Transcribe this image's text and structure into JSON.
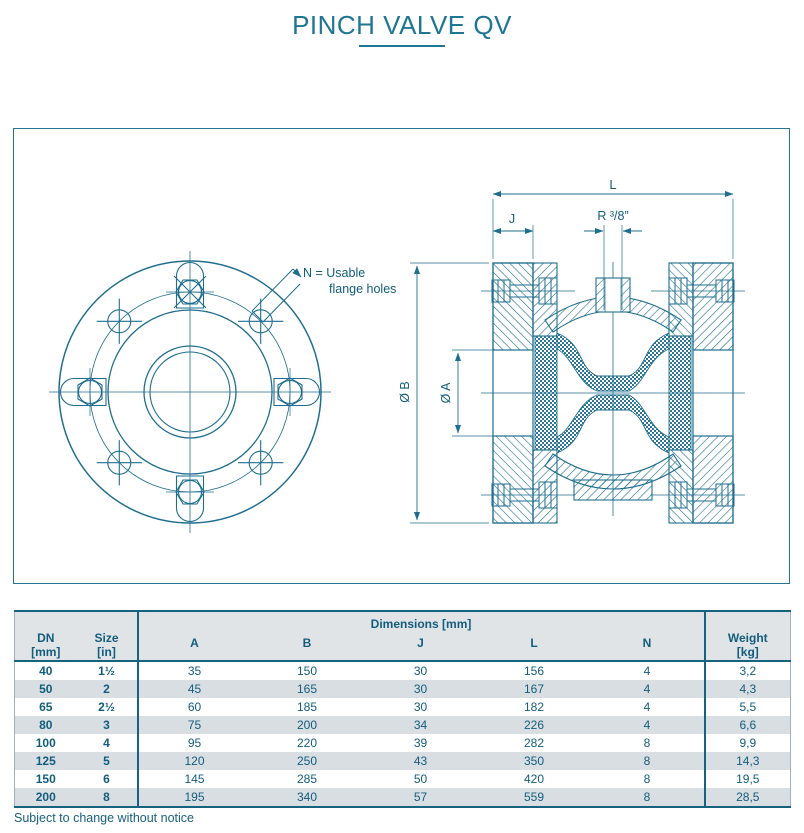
{
  "header": {
    "title": "PINCH VALVE QV"
  },
  "colors": {
    "accent_teal": "#1f6e8e",
    "text_teal": "#135d7c",
    "header_bg": "#e0e4e7",
    "row_stripe": "#d9dee3"
  },
  "drawing": {
    "note_line1": "N = Usable",
    "note_line2": "flange holes",
    "dim_l": "L",
    "dim_j": "J",
    "dim_r": "R ³/8”",
    "dim_db": "Ø B",
    "dim_da": "Ø A"
  },
  "table": {
    "col_dn": {
      "l1": "DN",
      "l2": "[mm]"
    },
    "col_size": {
      "l1": "Size",
      "l2": "[in]"
    },
    "dims_header": "Dimensions [mm]",
    "dim_cols": [
      "A",
      "B",
      "J",
      "L",
      "N"
    ],
    "col_weight": {
      "l1": "Weight",
      "l2": "[kg]"
    },
    "rows": [
      {
        "dn": "40",
        "size": "1½",
        "a": "35",
        "b": "150",
        "j": "30",
        "l": "156",
        "n": "4",
        "w": "3,2"
      },
      {
        "dn": "50",
        "size": "2",
        "a": "45",
        "b": "165",
        "j": "30",
        "l": "167",
        "n": "4",
        "w": "4,3"
      },
      {
        "dn": "65",
        "size": "2½",
        "a": "60",
        "b": "185",
        "j": "30",
        "l": "182",
        "n": "4",
        "w": "5,5"
      },
      {
        "dn": "80",
        "size": "3",
        "a": "75",
        "b": "200",
        "j": "34",
        "l": "226",
        "n": "4",
        "w": "6,6"
      },
      {
        "dn": "100",
        "size": "4",
        "a": "95",
        "b": "220",
        "j": "39",
        "l": "282",
        "n": "8",
        "w": "9,9"
      },
      {
        "dn": "125",
        "size": "5",
        "a": "120",
        "b": "250",
        "j": "43",
        "l": "350",
        "n": "8",
        "w": "14,3"
      },
      {
        "dn": "150",
        "size": "6",
        "a": "145",
        "b": "285",
        "j": "50",
        "l": "420",
        "n": "8",
        "w": "19,5"
      },
      {
        "dn": "200",
        "size": "8",
        "a": "195",
        "b": "340",
        "j": "57",
        "l": "559",
        "n": "8",
        "w": "28,5"
      }
    ]
  },
  "footer": {
    "note": "Subject to change without notice"
  }
}
